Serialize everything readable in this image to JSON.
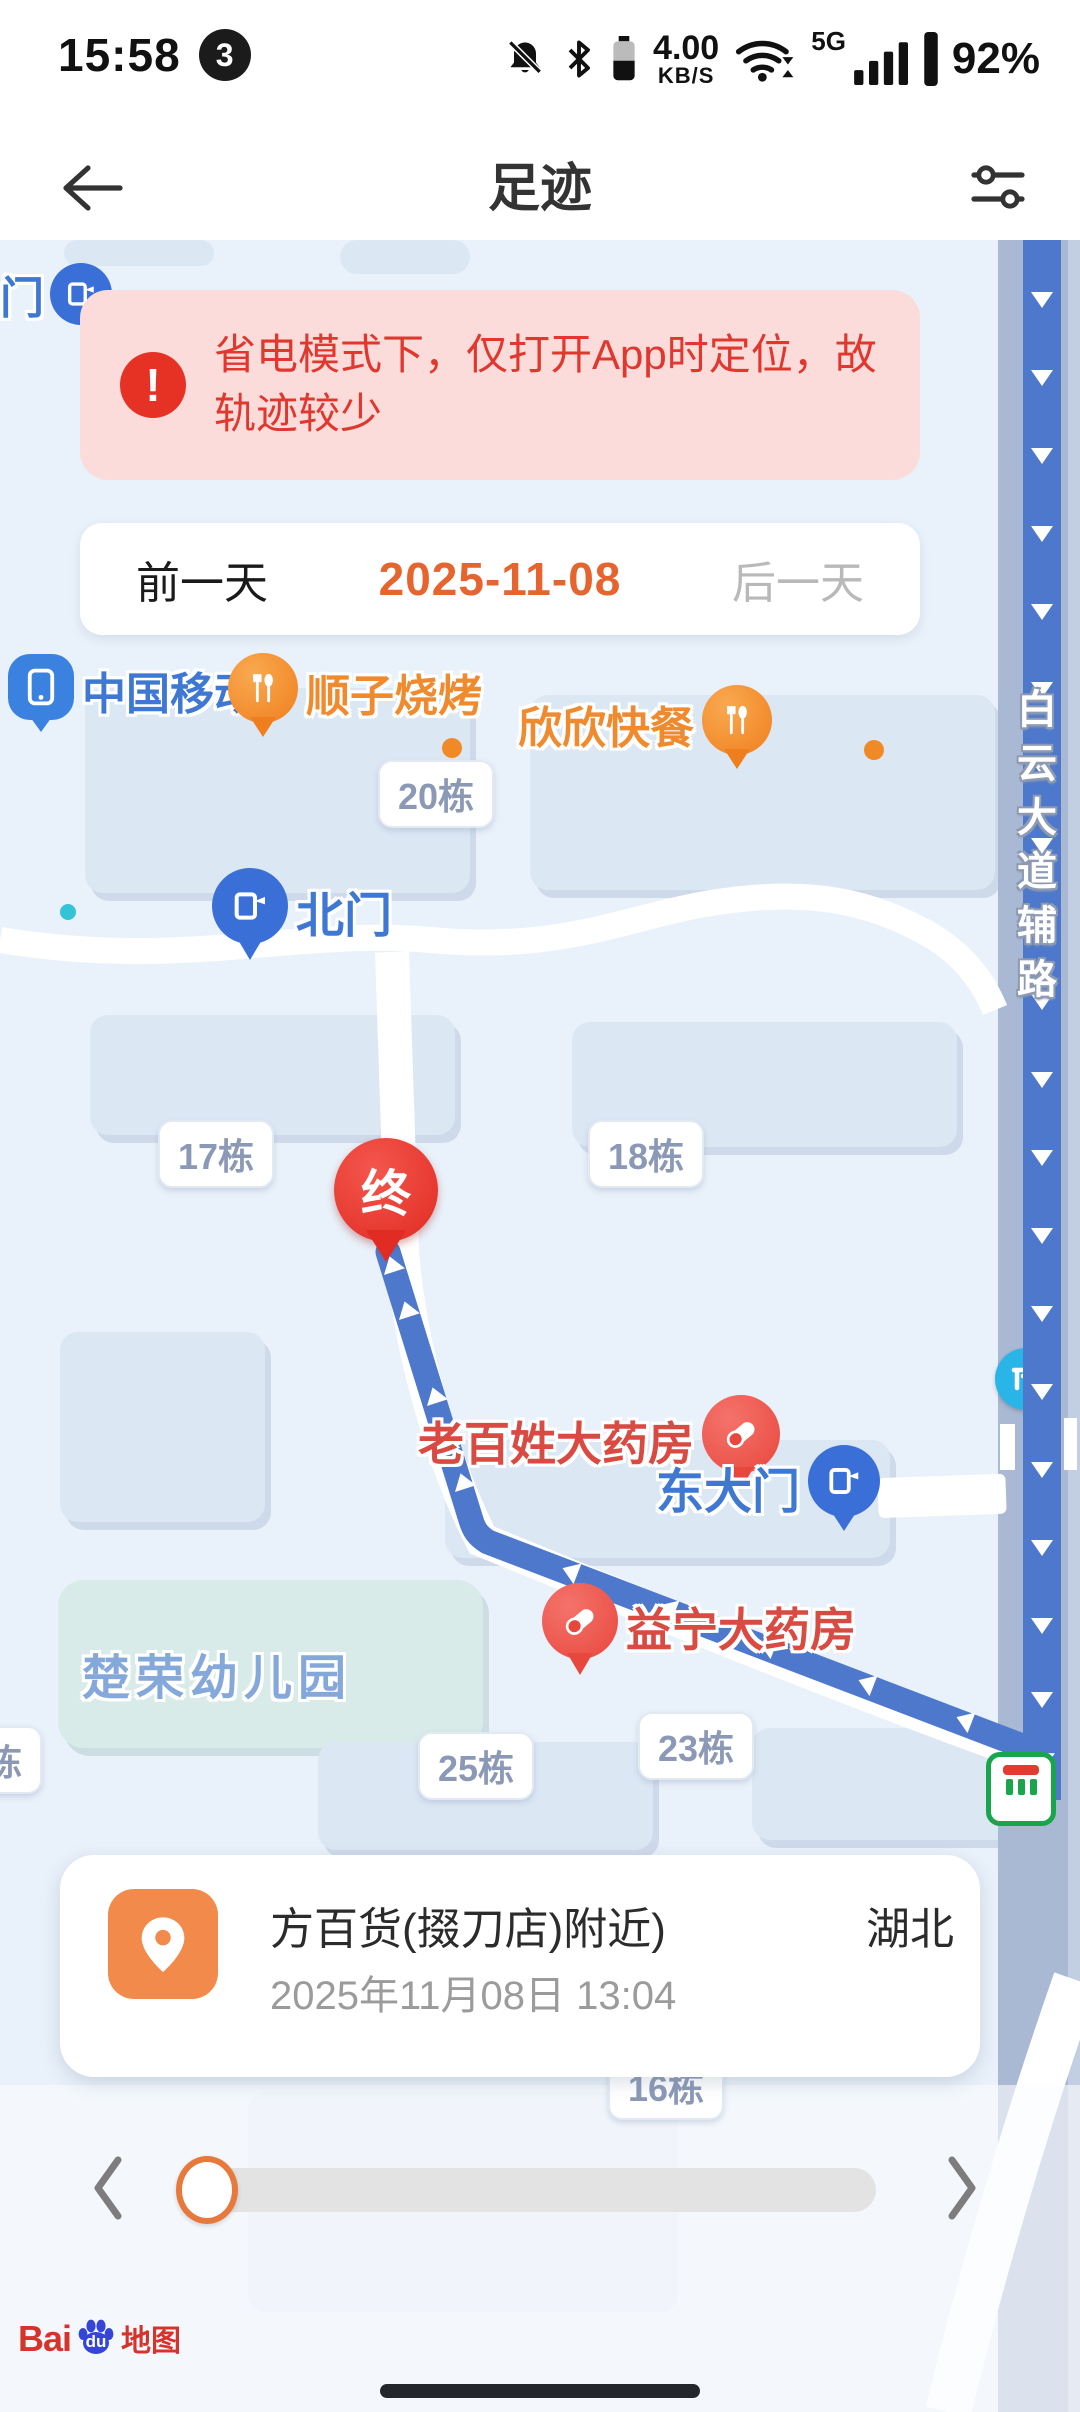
{
  "status_bar": {
    "time": "15:58",
    "badge": "3",
    "speed_value": "4.00",
    "speed_unit": "KB/S",
    "network": "5G",
    "battery": "92%"
  },
  "header": {
    "title": "足迹"
  },
  "banner": {
    "text": "省电模式下，仅打开App时定位，故轨迹较少"
  },
  "date_nav": {
    "prev": "前一天",
    "date": "2025-11-08",
    "next": "后一天"
  },
  "map": {
    "road_label": "白云大道辅路",
    "pois": {
      "gate_partial": "门",
      "china_mobile": "中国移动",
      "shunzi_bbq": "顺子烧烤",
      "xinxin_fastfood": "欣欣快餐",
      "north_gate": "北门",
      "east_gate": "东大门",
      "laobaixing_pharmacy": "老百姓大药房",
      "yining_pharmacy": "益宁大药房",
      "kindergarten": "楚荣幼儿园",
      "end_marker": "终",
      "bldg_20": "20栋",
      "bldg_17": "17栋",
      "bldg_18": "18栋",
      "bldg_25": "25栋",
      "bldg_23": "23栋",
      "bldg_16": "16栋",
      "bldg_left_partial": "栋"
    },
    "attribution": {
      "bai": "Bai",
      "du": "du",
      "map_text": "地图"
    }
  },
  "location_card": {
    "title": "方百货(掇刀店)附近)",
    "title_right": "湖北",
    "timestamp": "2025年11月08日 13:04"
  },
  "colors": {
    "banner_red": "#e0372e",
    "date_orange": "#e6642e",
    "route_blue": "#4d78cb",
    "card_icon_orange": "#f28a4b",
    "map_bg": "#e9f1fa"
  }
}
